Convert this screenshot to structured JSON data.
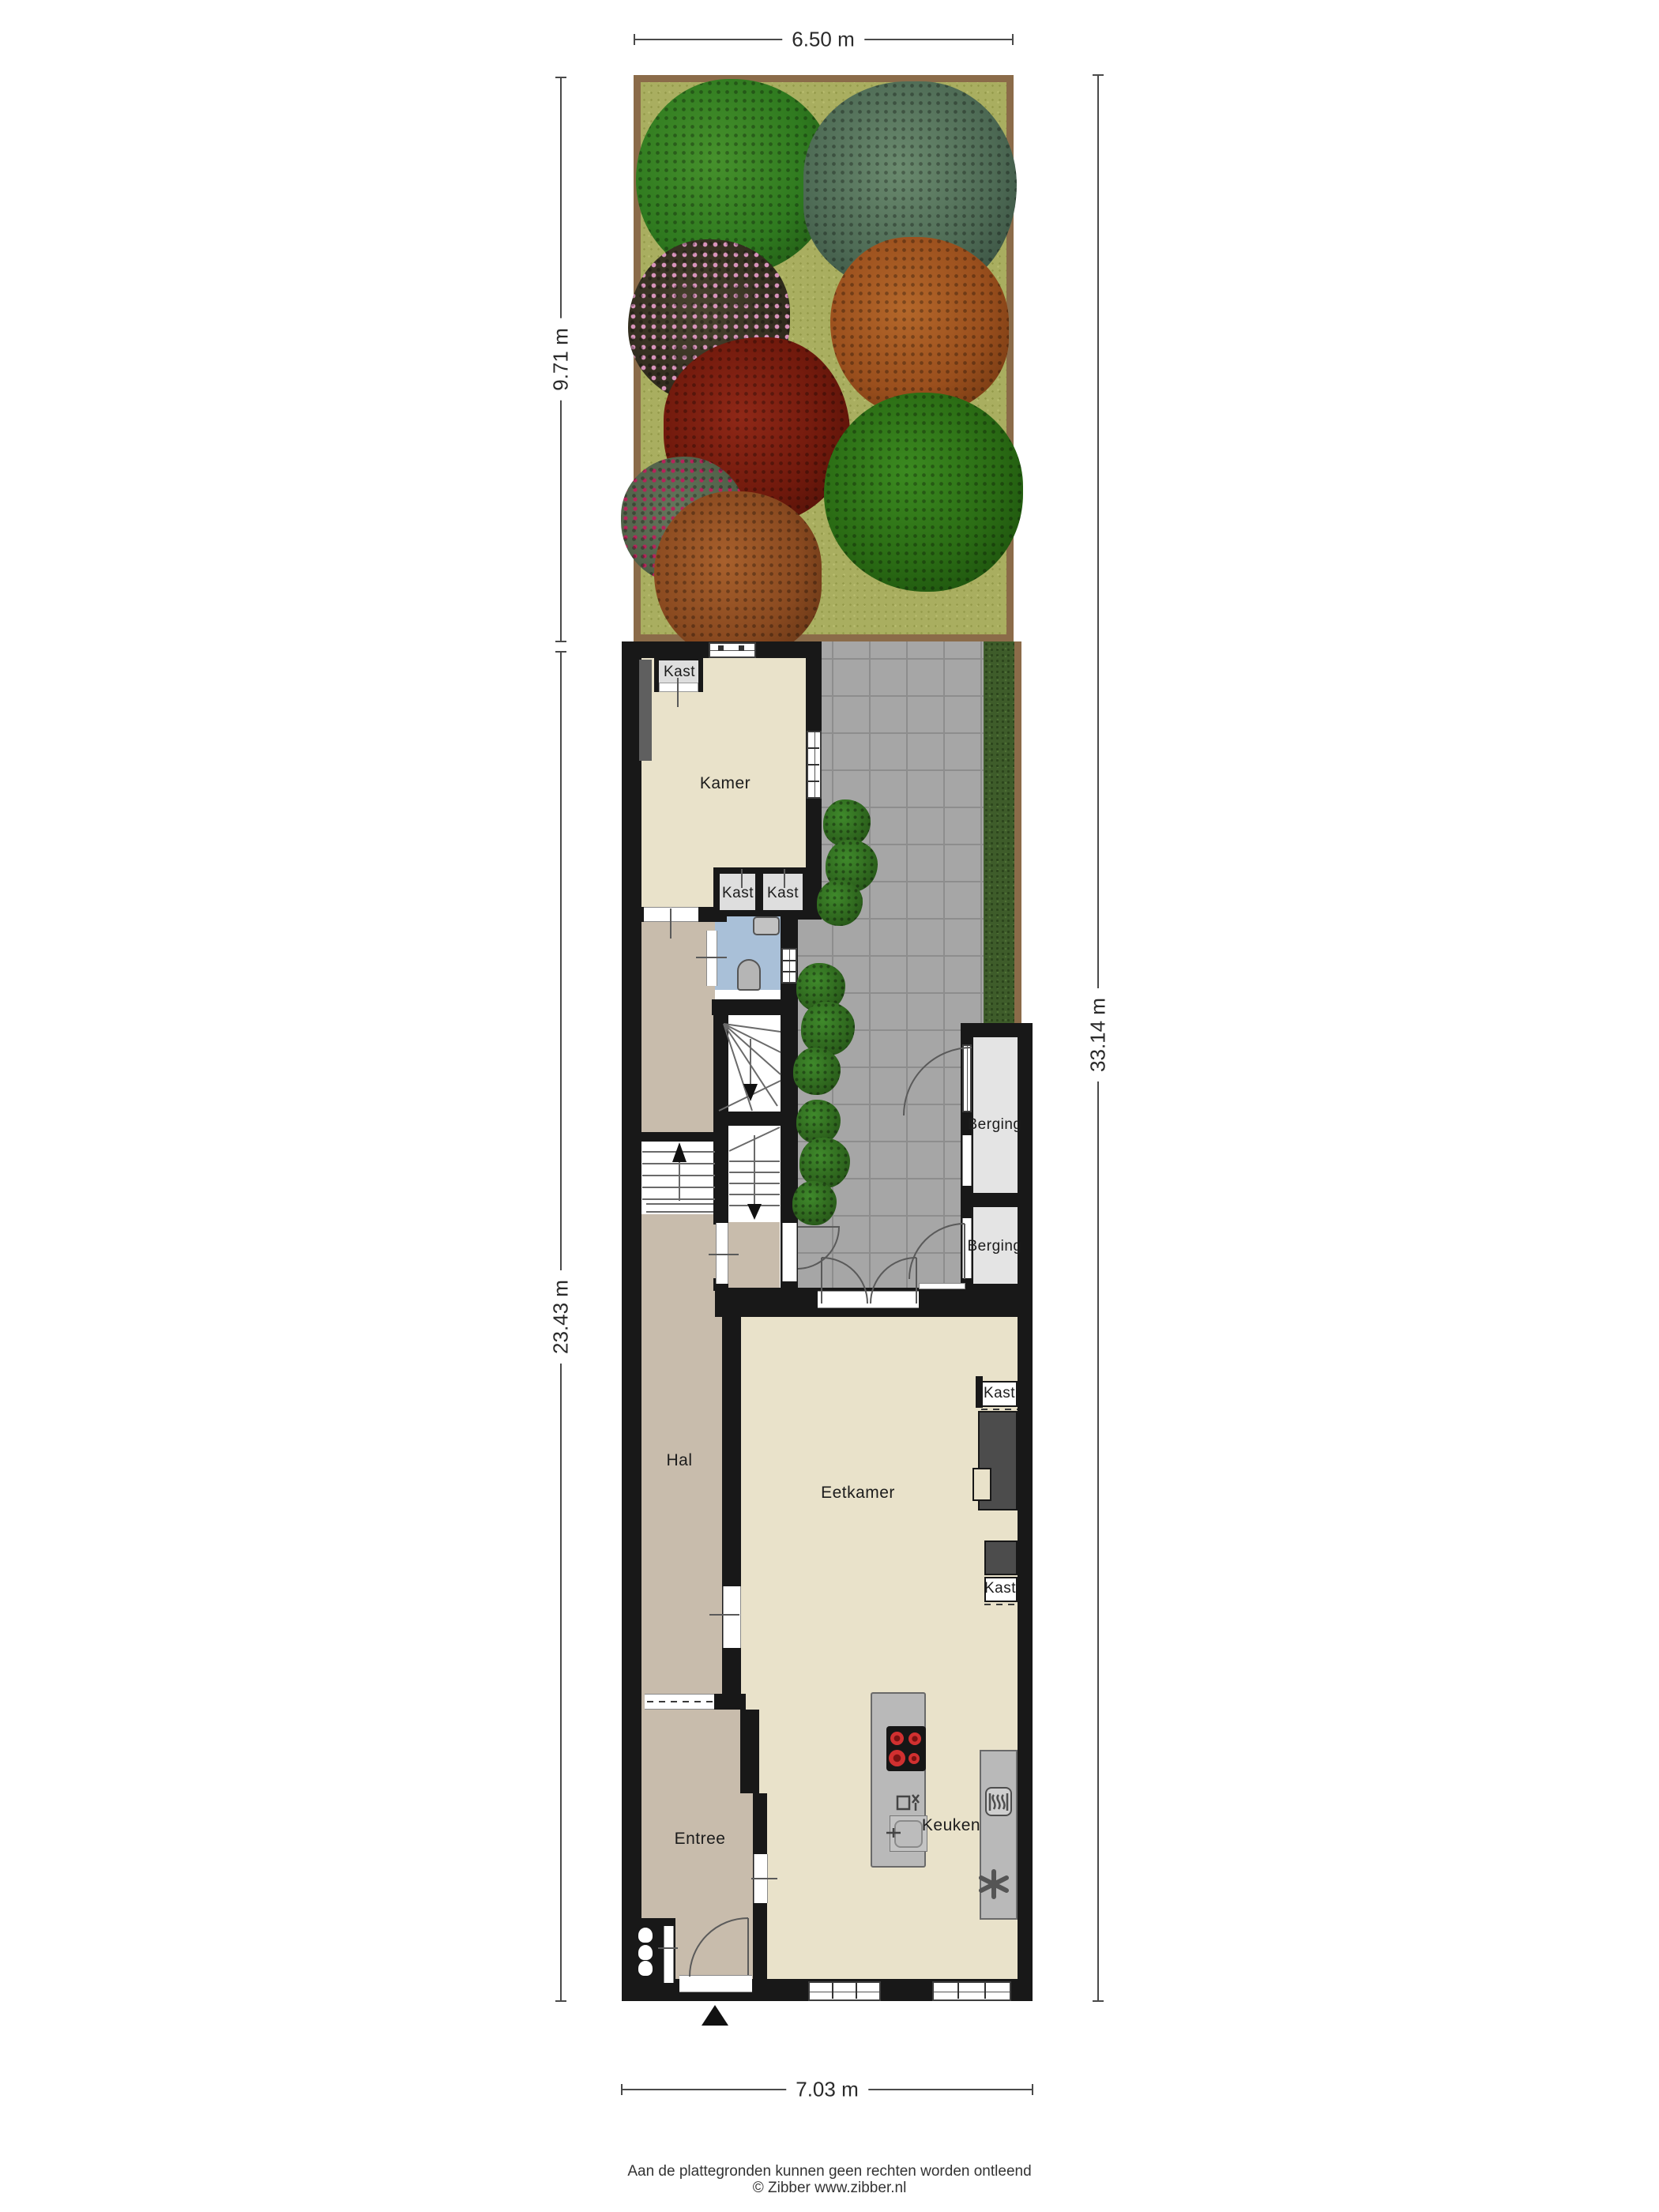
{
  "labels": {
    "kamer": "Kamer",
    "kast_top": "Kast",
    "kast_bottom_left": "Kast",
    "kast_bottom_right": "Kast",
    "berging_upper": "Berging",
    "berging_lower": "Berging",
    "hal": "Hal",
    "eetkamer": "Eetkamer",
    "kast_eetkamer_upper": "Kast",
    "kast_eetkamer_lower": "Kast",
    "entree": "Entree",
    "keuken": "Keuken"
  },
  "dimensions": {
    "top_width": "6.50 m",
    "garden_depth": "9.71 m",
    "house_depth": "23.43 m",
    "total_depth": "33.14 m",
    "bottom_width": "7.03 m"
  },
  "footer": {
    "line1": "Aan de plattegronden kunnen geen rechten worden ontleend",
    "line2": "© Zibber www.zibber.nl"
  },
  "colors": {
    "wall": "#181818",
    "grass": "#a9ae60",
    "garden_border": "#8b6b49",
    "patio_tile": "#a6a6a6",
    "hedge": "#3e5c2a",
    "floor_light": "#e9e2ca",
    "floor_tan": "#c8bcac",
    "bathroom_blue": "#a9c0d8",
    "closet_gray": "#dedede",
    "berging_gray": "#e4e4e4",
    "counter_gray": "#b9b9b9",
    "burner_red": "#d13030"
  }
}
